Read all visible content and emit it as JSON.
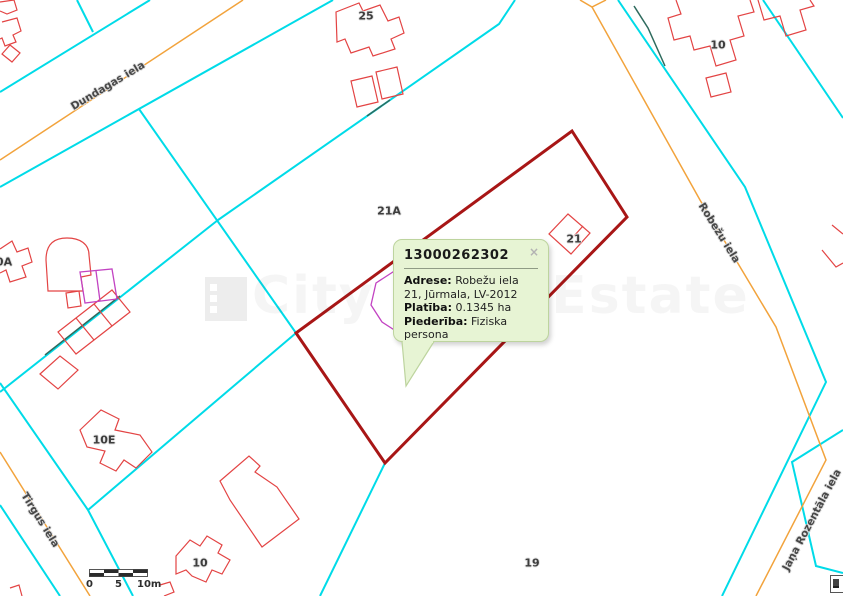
{
  "map": {
    "streets": {
      "dundagas": "Dundagas iela",
      "robezu": "Robežu iela",
      "tirgus": "Tirgus iela",
      "rozentala": "Jaņa Rozentāla iela"
    },
    "parcels": {
      "p25": "25",
      "p10_ne": "10",
      "p21a": "21A",
      "p21": "21",
      "p0a": "0A",
      "p10e": "10E",
      "p10_s": "10",
      "p19": "19"
    }
  },
  "popup": {
    "title": "13000262302",
    "close": "×",
    "rows": [
      {
        "label": "Adrese:",
        "value": "Robežu iela 21, Jūrmala, LV-2012"
      },
      {
        "label": "Platība:",
        "value": "0.1345 ha"
      },
      {
        "label": "Piederība:",
        "value": "Fiziska persona"
      }
    ]
  },
  "scale_bar": {
    "start": "0",
    "middle": "5",
    "end": "10m"
  },
  "watermark": {
    "text": "City Real Estate"
  },
  "colors": {
    "parcel_boundary": "#00dbe8",
    "street_centerline": "#f2a33c",
    "building_outline": "#e34444",
    "selected_parcel": "#a81616",
    "overlay_parcel": "#c243c2",
    "survey_segment": "#2f6b5e",
    "popup_bg": "#e7f4d4",
    "popup_border": "#bdd49e"
  }
}
